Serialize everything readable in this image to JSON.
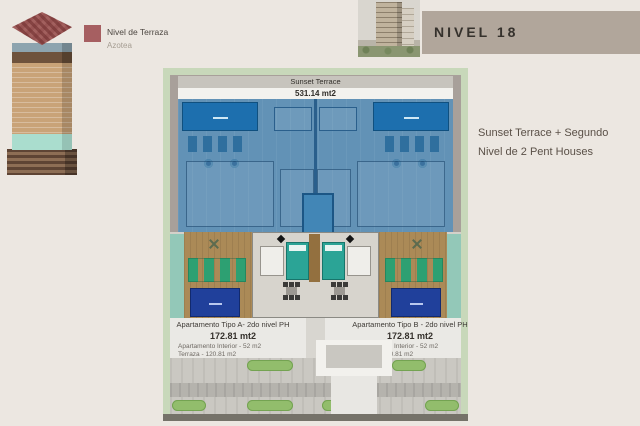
{
  "legend": {
    "title": "Nivel de Terraza",
    "subtitle": "Azotea"
  },
  "header": {
    "title": "NIVEL 18"
  },
  "description": {
    "line1": "Sunset Terrace + Segundo",
    "line2": "Nivel de 2 Pent Houses"
  },
  "plan": {
    "terrace_title": "Sunset Terrace",
    "terrace_area": "531.14 mt2",
    "apartments": [
      {
        "name": "Apartamento Tipo A- 2do nivel PH",
        "total": "172.81 mt2",
        "interior": "Apartamento Interior - 52 m2",
        "terrace": "Terraza - 120.81 m2"
      },
      {
        "name": "Apartamento Tipo B - 2do nivel PH",
        "total": "172.81 mt2",
        "interior": "Apartamento Interior - 52 m2",
        "terrace": "Terraza - 120.81 m2"
      }
    ]
  },
  "colors": {
    "page_background": "#ece7e1",
    "legend_swatch": "#a65f61",
    "header_bar": "#b1a69b",
    "plan_lawn_green": "#c8d8ba",
    "terrace_blue": "#6292b6",
    "pool_blue": "#1d6fae",
    "spa_navy": "#20409b",
    "deck_tan": "#ab8a57",
    "bed_teal": "#2ba496"
  }
}
